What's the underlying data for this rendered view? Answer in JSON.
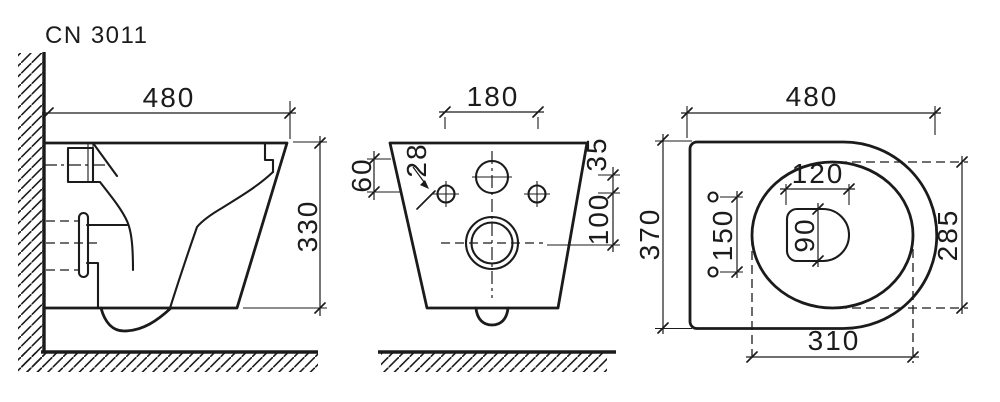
{
  "title": "CN 3011",
  "colors": {
    "line": "#1b1b1b",
    "background": "#ffffff"
  },
  "views": {
    "side": {
      "name": "side view (wall-hung toilet section)",
      "dims": {
        "overall_depth": "480",
        "overall_height": "330"
      }
    },
    "back": {
      "name": "back view (mounting face)",
      "dims": {
        "mount_hole_spacing": "180",
        "top_to_hole": "60",
        "mount_hole_diameter": "28",
        "inlet_to_holes": "35",
        "holes_to_drain": "100"
      }
    },
    "top": {
      "name": "top view (plan)",
      "dims": {
        "overall_depth": "480",
        "overall_width": "370",
        "seat_hole_spacing": "150",
        "sump_length": "120",
        "sump_width": "90",
        "bowl_width": "285",
        "bowl_length": "310"
      }
    }
  }
}
